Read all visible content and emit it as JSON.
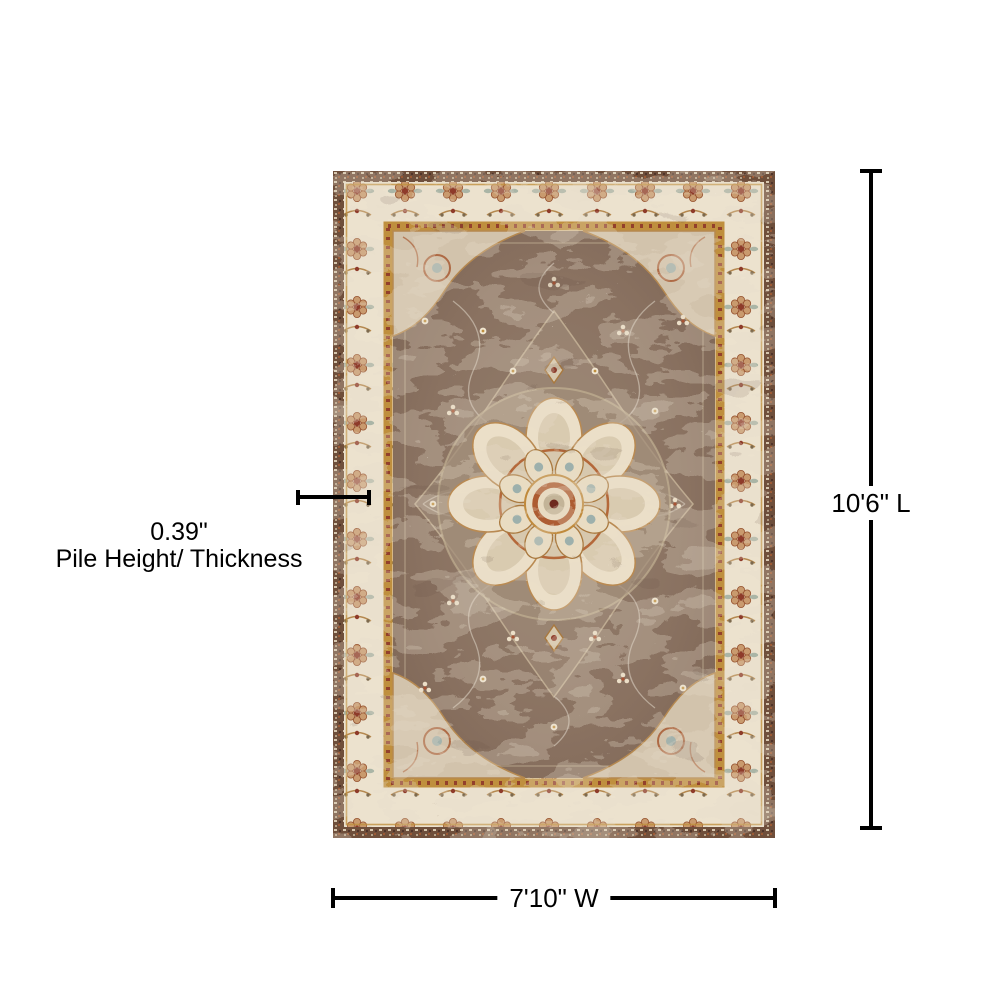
{
  "annotations": {
    "pile": {
      "value": "0.39\"",
      "label": "Pile Height/ Thickness"
    },
    "length": {
      "label": "10'6\" L"
    },
    "width": {
      "label": "7'10\" W"
    }
  },
  "colors": {
    "dimension_line": "#000000",
    "label_text": "#000000",
    "page_background": "#ffffff",
    "rug_field_brown": "#8a7261",
    "rug_border_cream": "#ece2ce",
    "rug_edge_brown": "#6f4f3b",
    "accent_rust": "#a85434",
    "accent_gold": "#bf8f3e",
    "accent_dark_red": "#8e3b2a",
    "accent_blue_gray": "#9fb3ae",
    "distress_light": "#e6dbc9"
  }
}
